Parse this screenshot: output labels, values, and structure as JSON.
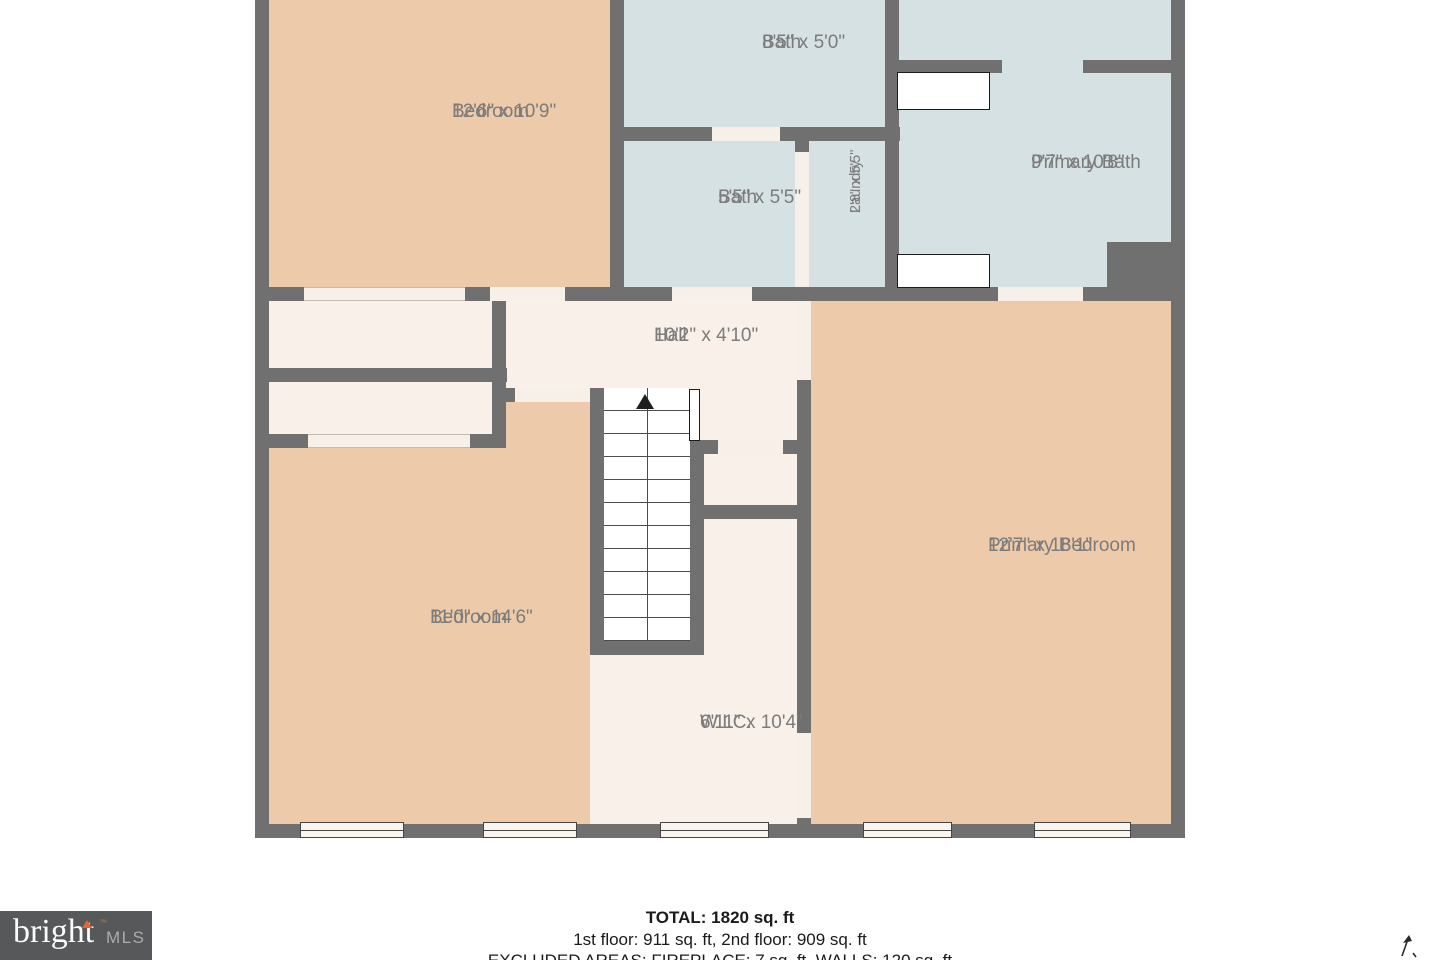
{
  "rooms": [
    {
      "name": "Bedroom",
      "dims": "12'6\" x 10'9\""
    },
    {
      "name": "Bath",
      "dims": "8'5\" x 5'0\""
    },
    {
      "name": "Bath",
      "dims": "5'5\" x 5'5\""
    },
    {
      "name": "Laundry",
      "dims": "2'8\" x 5'5\""
    },
    {
      "name": "Primary Bath",
      "dims": "9'7\" x 10'8\""
    },
    {
      "name": "Hall",
      "dims": "10'2\" x 4'10\""
    },
    {
      "name": "Bedroom",
      "dims": "11'0\" x 14'6\""
    },
    {
      "name": "W.I.C.",
      "dims": "6'11\" x 10'4\""
    },
    {
      "name": "Primary Bedroom",
      "dims": "12'7\" x 18'1\""
    }
  ],
  "footer": {
    "total": "TOTAL: 1820 sq. ft",
    "floors": "1st floor: 911 sq. ft, 2nd floor: 909 sq. ft",
    "excluded": "EXCLUDED AREAS: FIREPLACE: 7 sq. ft, WALLS: 120 sq. ft"
  },
  "logo": {
    "brand": "bright",
    "tm": "™",
    "suffix": "MLS"
  },
  "colors": {
    "wall": "#707070",
    "bedroom_fill": "#edcaa9",
    "bath_fill": "#d6e1e4",
    "hall_fill": "#f8f0e9",
    "label_text": "#7c7c7c",
    "logo_bg": "#57585a",
    "logo_accent": "#e0662f"
  }
}
